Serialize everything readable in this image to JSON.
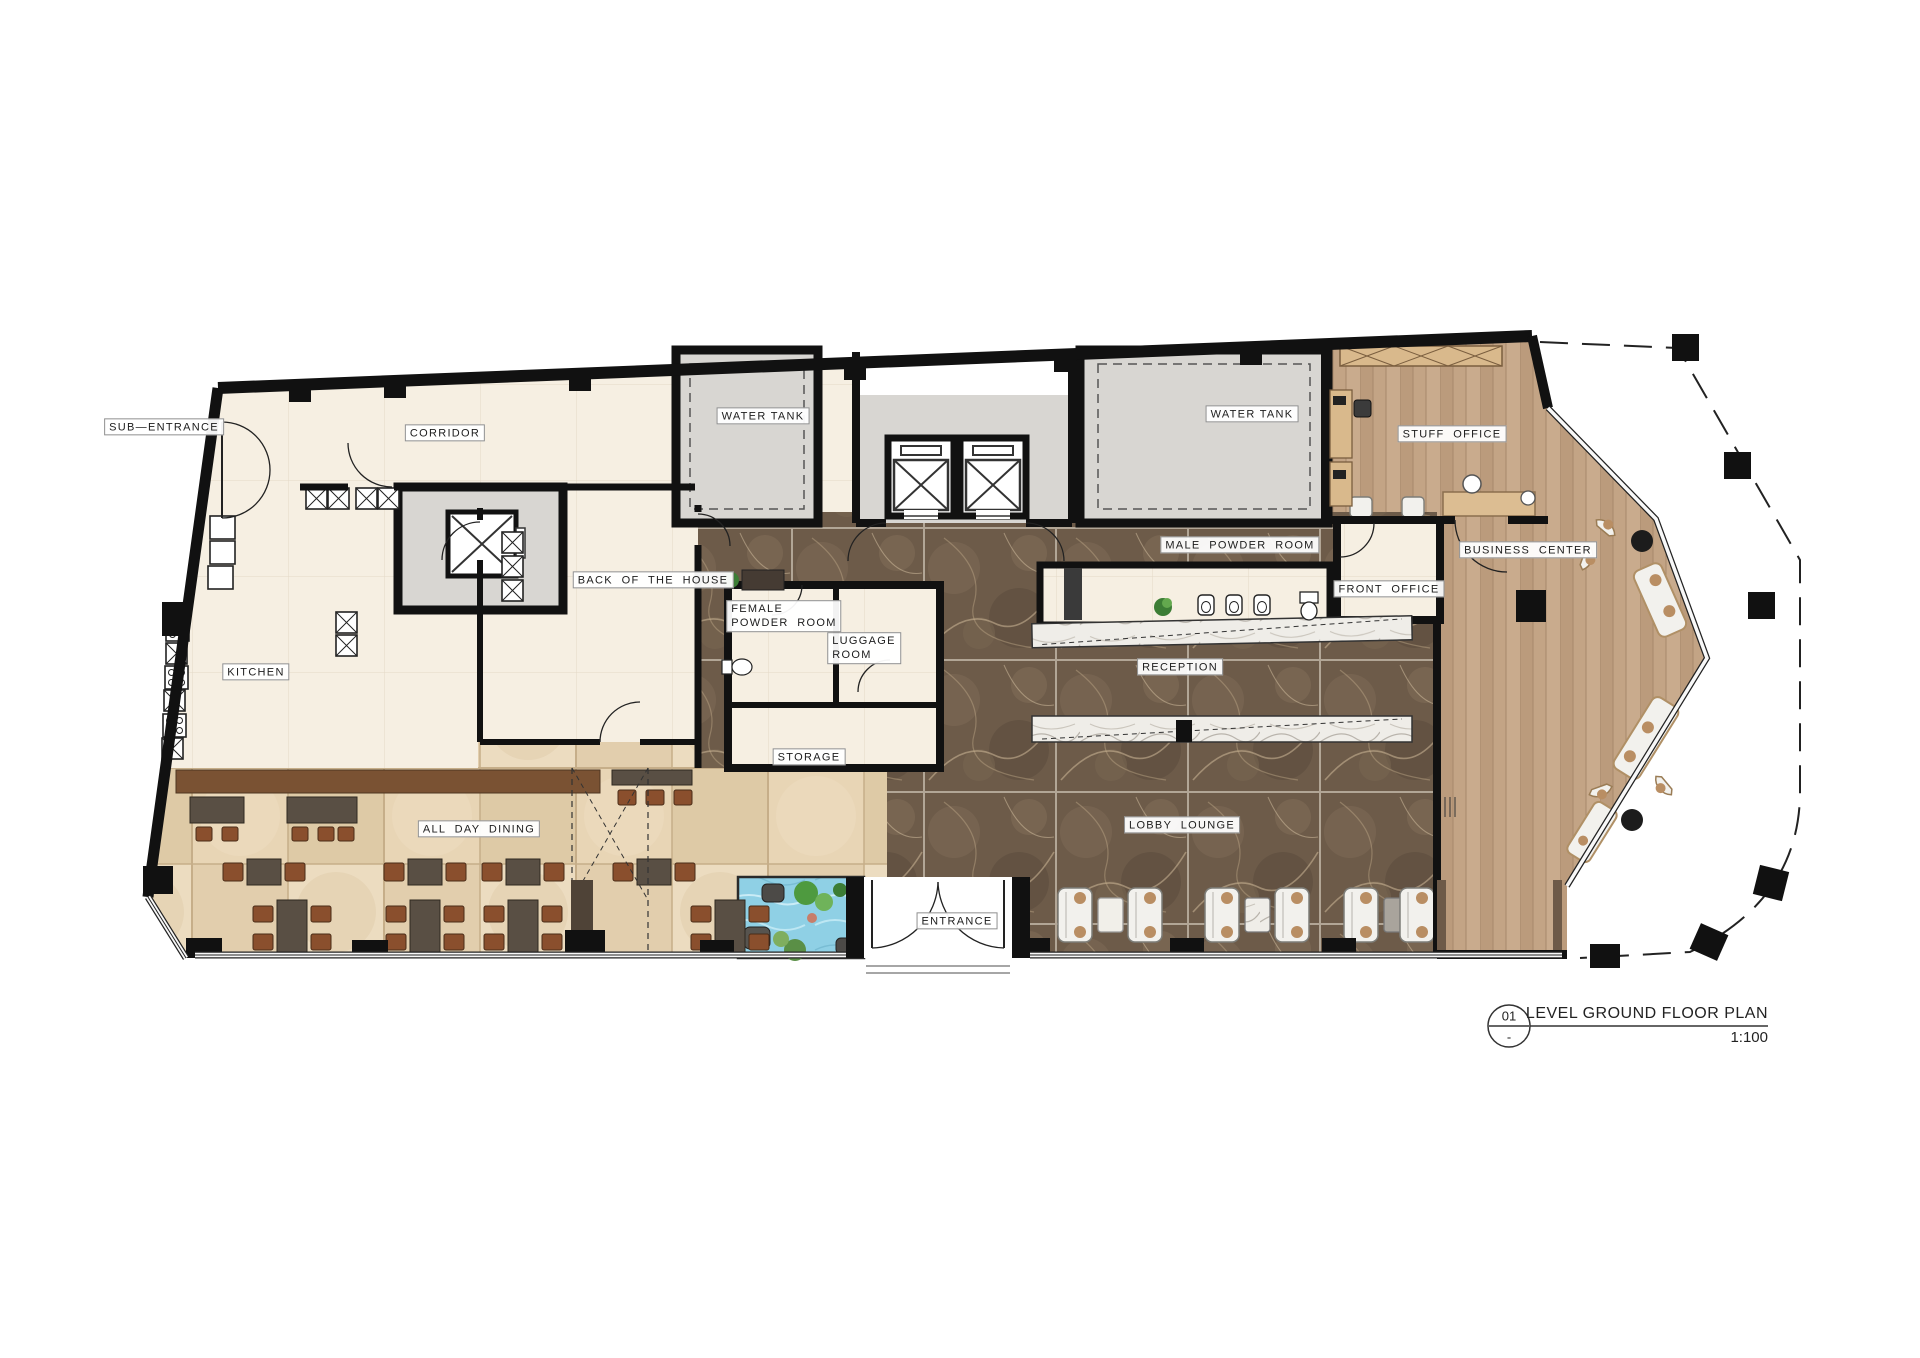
{
  "drawing": {
    "sheet_number": "01",
    "sheet_suffix": "-",
    "title": "LEVEL GROUND FLOOR PLAN",
    "scale": "1:100"
  },
  "rooms": {
    "sub_entrance": "SUB—ENTRANCE",
    "corridor": "CORRIDOR",
    "water_tank_left": "WATER TANK",
    "water_tank_right": "WATER TANK",
    "stuff_office": "STUFF  OFFICE",
    "male_powder_room": "MALE  POWDER  ROOM",
    "front_office": "FRONT  OFFICE",
    "business_center": "BUSINESS  CENTER",
    "back_of_the_house": "BACK  OF  THE  HOUSE",
    "female_powder_room": "FEMALE\nPOWDER  ROOM",
    "luggage_room": "LUGGAGE\nROOM",
    "kitchen": "KITCHEN",
    "reception": "RECEPTION",
    "storage": "STORAGE",
    "all_day_dining": "ALL  DAY  DINING",
    "lobby_lounge": "LOBBY  LOUNGE",
    "entrance": "ENTRANCE"
  },
  "palette": {
    "wall": "#111111",
    "cream_floor": "#f6efe2",
    "concrete_gray": "#d8d6d2",
    "marble_dark_brown": "#6d5b49",
    "tile_beige": "#e3cfae",
    "wood_floor": "#c2a384",
    "pool_blue": "#8fd0e5",
    "bar_counter": "#7a5233",
    "chair_brown": "#8a4f2d",
    "table_wood": "#594f44"
  }
}
